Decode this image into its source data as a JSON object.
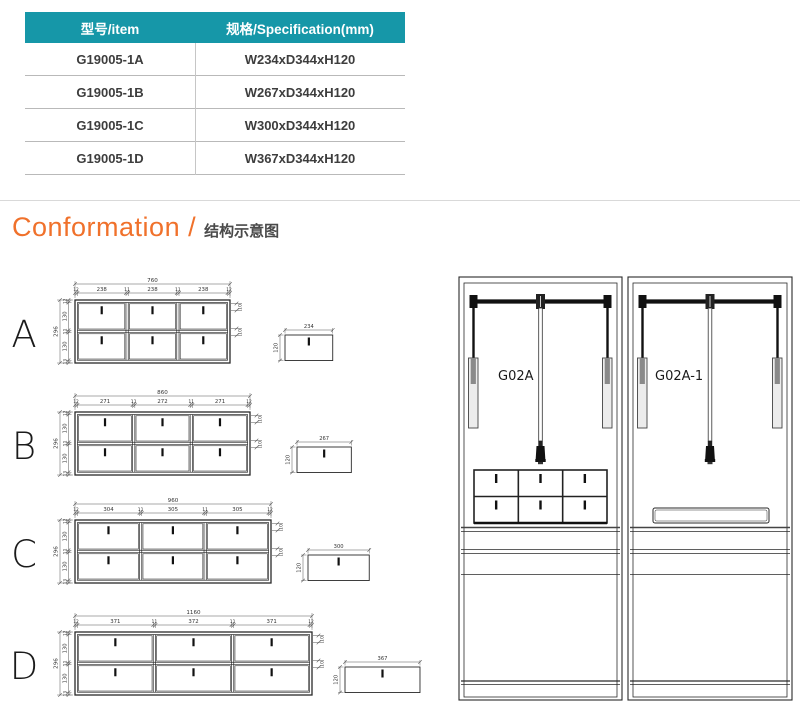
{
  "table": {
    "col1_header": "型号/item",
    "col2_header": "规格/Specification(mm)",
    "rows": [
      [
        "G19005-1A",
        "W234xD344xH120"
      ],
      [
        "G19005-1B",
        "W267xD344xH120"
      ],
      [
        "G19005-1C",
        "W300xD344xH120"
      ],
      [
        "G19005-1D",
        "W367xD344xH120"
      ]
    ]
  },
  "section_title": {
    "en": "Conformation /",
    "zh": "结构示意图"
  },
  "drawings": [
    {
      "letter": "A",
      "total_width": "760",
      "widths": [
        "238",
        "238",
        "238"
      ],
      "gap": "11",
      "edge": "12",
      "total_height": "296",
      "heights": [
        "130",
        "130"
      ],
      "v_gap": "11",
      "v_top": "12",
      "v_bottom": "13",
      "right_gap": "10",
      "side_width": "234",
      "side_height": "120"
    },
    {
      "letter": "B",
      "total_width": "860",
      "widths": [
        "271",
        "272",
        "271"
      ],
      "gap": "11",
      "edge": "12",
      "total_height": "296",
      "heights": [
        "130",
        "130"
      ],
      "v_gap": "11",
      "v_top": "12",
      "v_bottom": "13",
      "right_gap": "10",
      "side_width": "267",
      "side_height": "120"
    },
    {
      "letter": "C",
      "total_width": "960",
      "widths": [
        "304",
        "305",
        "305"
      ],
      "gap": "11",
      "edge": "12",
      "total_height": "296",
      "heights": [
        "130",
        "130"
      ],
      "v_gap": "11",
      "v_top": "12",
      "v_bottom": "13",
      "right_gap": "10",
      "side_width": "300",
      "side_height": "120"
    },
    {
      "letter": "D",
      "total_width": "1160",
      "widths": [
        "371",
        "372",
        "371"
      ],
      "gap": "11",
      "edge": "12",
      "total_height": "296",
      "heights": [
        "130",
        "130"
      ],
      "v_gap": "11",
      "v_top": "12",
      "v_bottom": "13",
      "right_gap": "10",
      "side_width": "367",
      "side_height": "120"
    }
  ],
  "cabinets": [
    {
      "label": "G02A"
    },
    {
      "label": "G02A-1"
    }
  ],
  "colors": {
    "table_header_bg": "#1697A8",
    "accent_orange": "#F0712B",
    "line_dark": "#2a2a2a",
    "dim_line": "#555555"
  }
}
